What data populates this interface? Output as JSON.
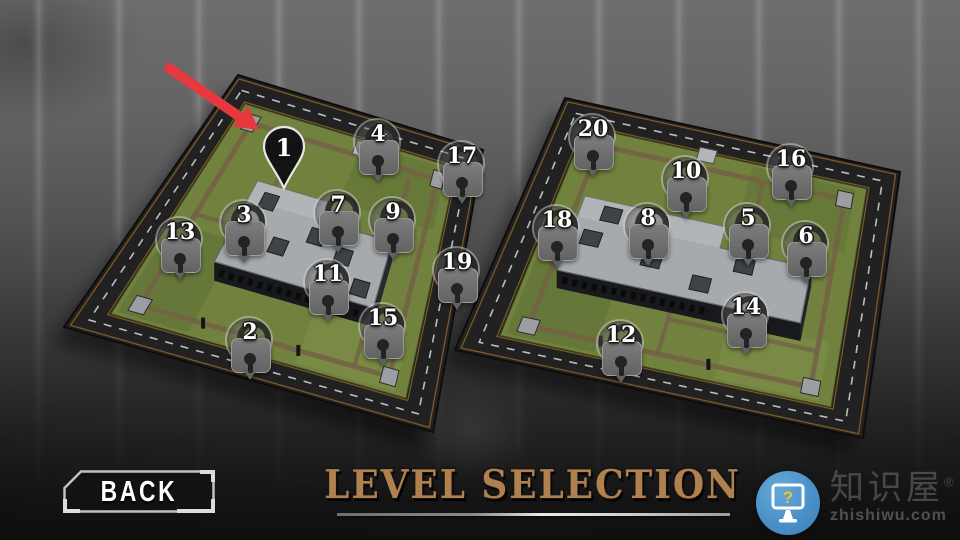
{
  "title": {
    "text": "LEVEL SELECTION"
  },
  "back_button": {
    "label": "BACK"
  },
  "level_map": {
    "selected_level": "1",
    "pin_icons": {
      "locked": "padlock-icon",
      "selected": "map-pin-icon"
    },
    "maps": [
      {
        "id": "map-1",
        "pins": [
          {
            "num": "1",
            "x": 284,
            "y": 148,
            "state": "selected"
          },
          {
            "num": "4",
            "x": 378,
            "y": 143,
            "state": "locked"
          },
          {
            "num": "17",
            "x": 462,
            "y": 165,
            "state": "locked"
          },
          {
            "num": "13",
            "x": 180,
            "y": 241,
            "state": "locked"
          },
          {
            "num": "3",
            "x": 244,
            "y": 224,
            "state": "locked"
          },
          {
            "num": "7",
            "x": 338,
            "y": 214,
            "state": "locked"
          },
          {
            "num": "9",
            "x": 393,
            "y": 221,
            "state": "locked"
          },
          {
            "num": "11",
            "x": 328,
            "y": 283,
            "state": "locked"
          },
          {
            "num": "19",
            "x": 457,
            "y": 271,
            "state": "locked"
          },
          {
            "num": "2",
            "x": 250,
            "y": 341,
            "state": "locked"
          },
          {
            "num": "15",
            "x": 383,
            "y": 327,
            "state": "locked"
          }
        ]
      },
      {
        "id": "map-2",
        "pins": [
          {
            "num": "20",
            "x": 593,
            "y": 138,
            "state": "locked"
          },
          {
            "num": "10",
            "x": 686,
            "y": 180,
            "state": "locked"
          },
          {
            "num": "16",
            "x": 791,
            "y": 168,
            "state": "locked"
          },
          {
            "num": "18",
            "x": 557,
            "y": 229,
            "state": "locked"
          },
          {
            "num": "8",
            "x": 648,
            "y": 227,
            "state": "locked"
          },
          {
            "num": "5",
            "x": 748,
            "y": 227,
            "state": "locked"
          },
          {
            "num": "6",
            "x": 806,
            "y": 245,
            "state": "locked"
          },
          {
            "num": "14",
            "x": 746,
            "y": 316,
            "state": "locked"
          },
          {
            "num": "12",
            "x": 621,
            "y": 344,
            "state": "locked"
          }
        ]
      }
    ]
  },
  "watermark": {
    "brand": "知识屋",
    "reg_mark": "®",
    "domain": "zhishiwu.com",
    "icon": "monitor-question-icon",
    "icon_glyph": "?"
  },
  "colors": {
    "accent_red": "#e73840",
    "title_tan": "#b0814e",
    "pin_gray": "#6f6f6f",
    "pin_selected_bg": "#141414",
    "grass_green": "#71823e",
    "road_dark": "#212121",
    "watermark_blue": "#4a90c8"
  }
}
